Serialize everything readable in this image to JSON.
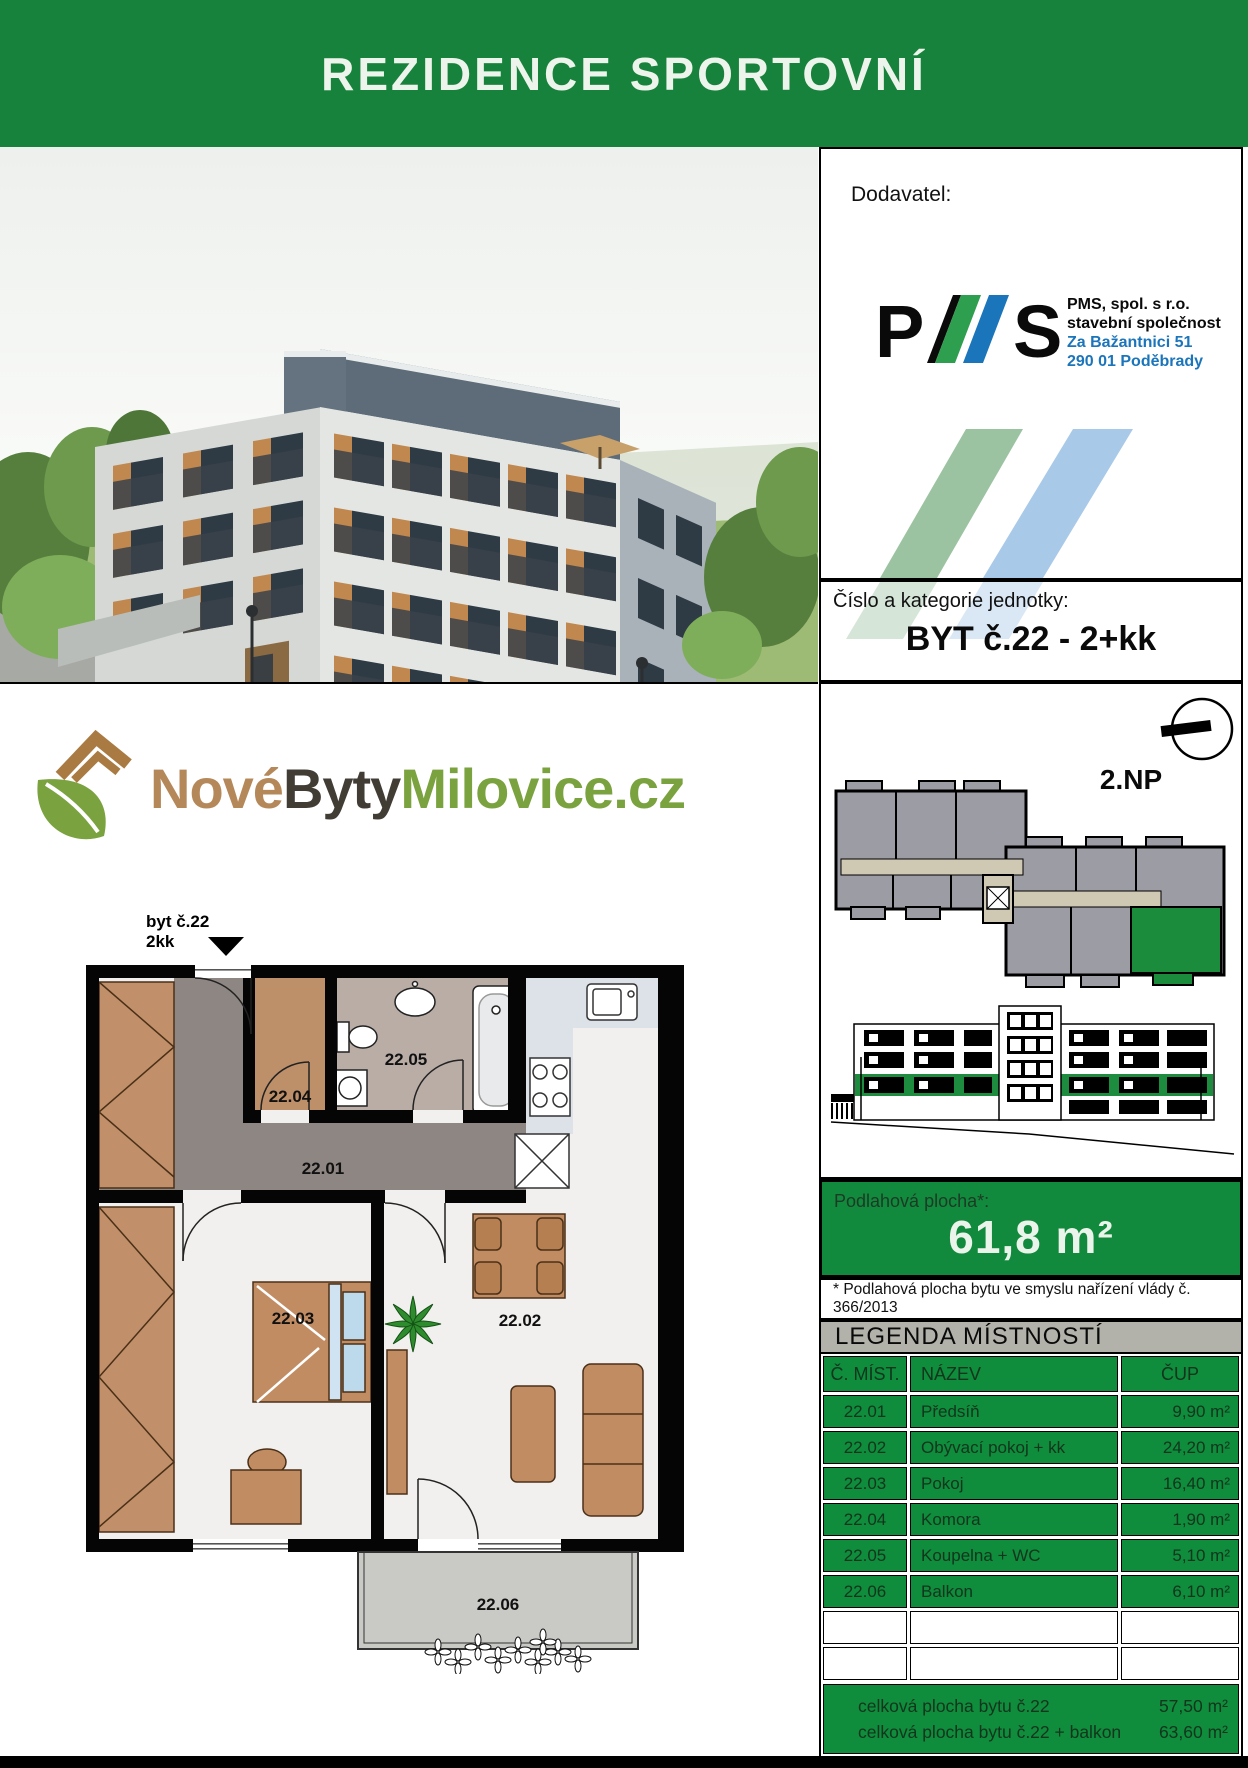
{
  "header": {
    "title": "REZIDENCE SPORTOVNÍ"
  },
  "supplier": {
    "label": "Dodavatel:",
    "logo": {
      "letter_p": "P",
      "letter_s": "S"
    },
    "company_line1": "PMS, spol. s r.o.",
    "company_line2": "stavební společnost",
    "address_line1": "Za Bažantnici 51",
    "address_line2": "290 01 Poděbrady"
  },
  "unit": {
    "label": "Číslo a kategorie jednotky:",
    "value": "BYT č.22 - 2+kk"
  },
  "floor_overview": {
    "floor_label": "2.NP"
  },
  "area": {
    "label": "Podlahová plocha*:",
    "value": "61,8 m²",
    "footnote": "* Podlahová plocha bytu ve smyslu nařízení vlády č. 366/2013"
  },
  "legend": {
    "title": "LEGENDA MÍSTNOSTÍ",
    "columns": {
      "no": "Č. MÍST.",
      "name": "NÁZEV",
      "area": "ČUP"
    },
    "rows": [
      {
        "no": "22.01",
        "name": "Předsíň",
        "area": "9,90 m²"
      },
      {
        "no": "22.02",
        "name": "Obývací pokoj + kk",
        "area": "24,20 m²"
      },
      {
        "no": "22.03",
        "name": "Pokoj",
        "area": "16,40 m²"
      },
      {
        "no": "22.04",
        "name": "Komora",
        "area": "1,90 m²"
      },
      {
        "no": "22.05",
        "name": "Koupelna + WC",
        "area": "5,10 m²"
      },
      {
        "no": "22.06",
        "name": "Balkon",
        "area": "6,10 m²"
      }
    ],
    "totals": [
      {
        "label": "celková plocha bytu č.22",
        "value": "57,50 m²"
      },
      {
        "label": "celková plocha bytu č.22 + balkon",
        "value": "63,60 m²"
      }
    ]
  },
  "brand": {
    "word1": "Nové",
    "word2": "Byty",
    "word3": "Milovice",
    "word4": ".cz"
  },
  "plan": {
    "unit_label": "byt č.22",
    "unit_type": "2kk",
    "rooms": {
      "r2201": "22.01",
      "r2202": "22.02",
      "r2203": "22.03",
      "r2204": "22.04",
      "r2205": "22.05",
      "r2206": "22.06"
    }
  },
  "colors": {
    "header_green": "#17823B",
    "table_green": "#0F8C3C",
    "area_box_green": "#128A3E",
    "highlight_green": "#1B8C3C",
    "stripe_green": "#9CC3A1",
    "stripe_blue": "#A9C9E9",
    "logo_blue": "#1B75BB",
    "logo_green": "#2E9E4F",
    "brand_brown": "#B5885A",
    "brand_green": "#7AA23F"
  }
}
